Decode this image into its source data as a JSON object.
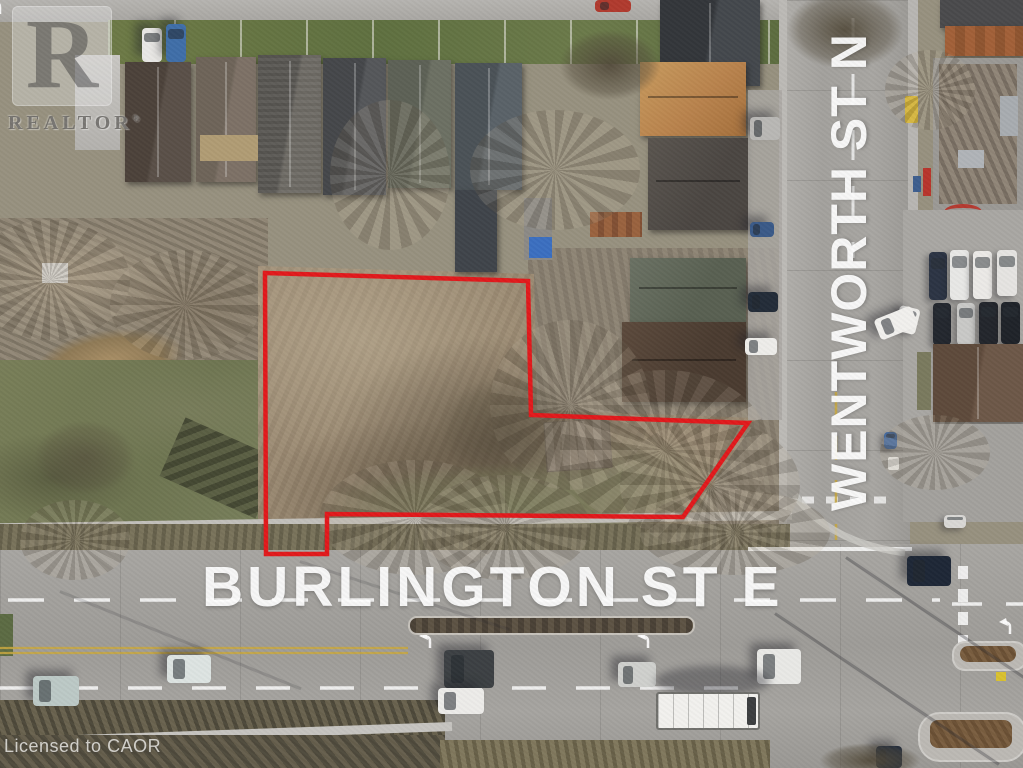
{
  "watermark": {
    "logo_letter": "R",
    "logo_text": "REALTOR",
    "registered_mark": "®"
  },
  "license": {
    "text": "Licensed to CAOR"
  },
  "street_labels": {
    "horizontal": "BURLINGTON ST E",
    "vertical": "WENTWORTH ST N"
  },
  "boundary": {
    "color": "#e2191c",
    "points": "265,273 528,281 531,415 748,423 683,517 327,514 327,554 266,554"
  }
}
